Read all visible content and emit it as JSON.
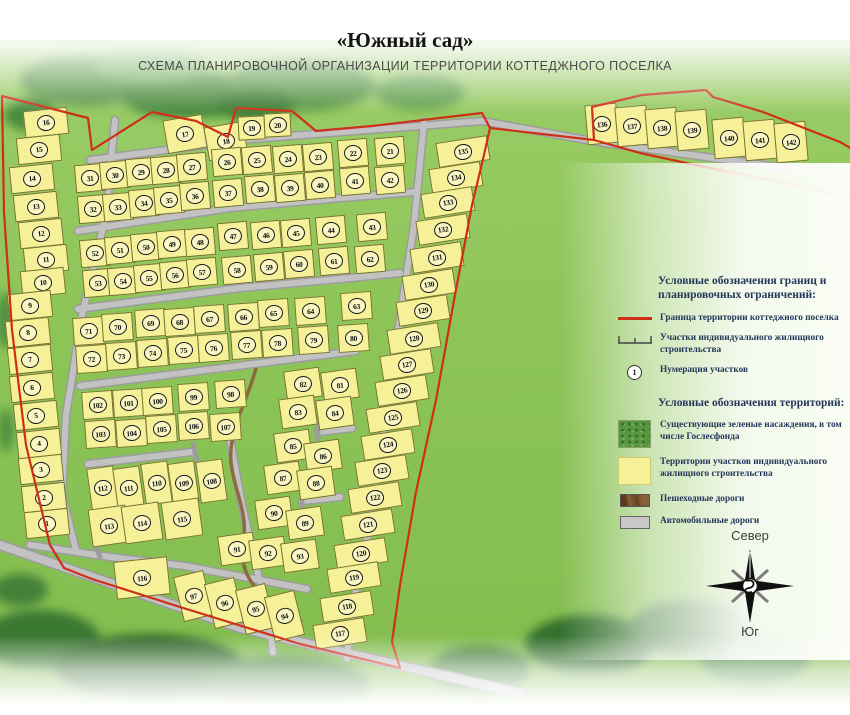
{
  "title": "«Южный сад»",
  "subtitle": "СХЕМА ПЛАНИРОВОЧНОЙ ОРГАНИЗАЦИИ ТЕРРИТОРИИ КОТТЕДЖНОГО ПОСЕЛКА",
  "compass": {
    "north": "Север",
    "south": "Юг"
  },
  "legend": {
    "boundaries": {
      "header": "Условные обозначения границ и планировочных ограничений:",
      "items": [
        {
          "icon": "red-line",
          "label": "Граница территории коттеджного поселка"
        },
        {
          "icon": "survey-line",
          "label": "Участки индивидуального жилищного строительства"
        },
        {
          "icon": "numbered-circle",
          "icon_text": "1",
          "label": "Нумерация участков"
        }
      ]
    },
    "territories": {
      "header": "Условные обозначения территорий:",
      "items": [
        {
          "icon": "green-swatch",
          "label": "Существующие зеленые насаждения, в том числе Гослесфонда"
        },
        {
          "icon": "yellow-swatch",
          "label": "Территории участков индивидуального жилищного строительства"
        },
        {
          "icon": "brown-swatch",
          "label": "Пешеходные дороги"
        },
        {
          "icon": "gray-swatch",
          "label": "Автомобильные дороги"
        }
      ]
    }
  },
  "colors": {
    "boundary-red": "#cf2e18",
    "plot-yellow": "#f6f099",
    "map-green": "#8cc457",
    "road-gray": "#c2c2c2",
    "path-brown": "#8a6038",
    "legend-text": "#24375a"
  },
  "map": {
    "plot_groups": [
      {
        "name": "left-column",
        "w": 44,
        "h": 27,
        "angle": -6,
        "plots": [
          [
            16,
            46,
            122
          ],
          [
            15,
            39,
            149
          ],
          [
            14,
            32,
            178
          ],
          [
            13,
            36,
            206
          ],
          [
            12,
            41,
            233
          ],
          [
            11,
            46,
            259
          ],
          [
            10,
            43,
            282
          ],
          [
            9,
            30,
            305
          ],
          [
            8,
            28,
            332
          ],
          [
            7,
            30,
            359
          ],
          [
            6,
            32,
            387
          ],
          [
            5,
            36,
            415
          ],
          [
            4,
            39,
            443
          ],
          [
            3,
            41,
            469
          ],
          [
            2,
            44,
            497
          ],
          [
            1,
            47,
            523
          ]
        ]
      },
      {
        "name": "north-west-pair",
        "w": 40,
        "h": 34,
        "angle": -10,
        "plots": [
          [
            17,
            185,
            134
          ],
          [
            18,
            226,
            141
          ]
        ]
      },
      {
        "name": "north-pair",
        "w": 27,
        "h": 24,
        "angle": -3,
        "plots": [
          [
            19,
            251,
            128
          ],
          [
            20,
            277,
            125
          ]
        ]
      },
      {
        "name": "block-a",
        "w": 30,
        "h": 28,
        "angle": -5,
        "plots": [
          [
            31,
            90,
            178
          ],
          [
            30,
            115,
            175
          ],
          [
            29,
            141,
            172
          ],
          [
            28,
            166,
            170
          ],
          [
            27,
            192,
            167
          ],
          [
            26,
            227,
            162
          ],
          [
            25,
            257,
            160
          ],
          [
            24,
            288,
            159
          ],
          [
            23,
            318,
            157
          ],
          [
            22,
            353,
            153
          ],
          [
            21,
            390,
            151
          ],
          [
            32,
            93,
            209
          ],
          [
            33,
            118,
            207
          ],
          [
            34,
            144,
            203
          ],
          [
            35,
            169,
            200
          ],
          [
            36,
            195,
            196
          ],
          [
            37,
            228,
            193
          ],
          [
            38,
            260,
            189
          ],
          [
            39,
            290,
            188
          ],
          [
            40,
            320,
            185
          ],
          [
            41,
            355,
            181
          ],
          [
            42,
            390,
            180
          ]
        ]
      },
      {
        "name": "block-b",
        "w": 30,
        "h": 28,
        "angle": -5,
        "plots": [
          [
            52,
            95,
            253
          ],
          [
            51,
            120,
            250
          ],
          [
            50,
            146,
            247
          ],
          [
            49,
            172,
            244
          ],
          [
            48,
            200,
            242
          ],
          [
            47,
            233,
            236
          ],
          [
            46,
            266,
            235
          ],
          [
            45,
            296,
            233
          ],
          [
            44,
            331,
            230
          ],
          [
            43,
            372,
            227
          ],
          [
            53,
            98,
            283
          ],
          [
            54,
            123,
            281
          ],
          [
            55,
            149,
            278
          ],
          [
            56,
            175,
            275
          ],
          [
            57,
            202,
            272
          ],
          [
            58,
            237,
            270
          ],
          [
            59,
            269,
            267
          ],
          [
            60,
            299,
            264
          ],
          [
            61,
            334,
            261
          ],
          [
            62,
            370,
            259
          ]
        ]
      },
      {
        "name": "block-c",
        "w": 31,
        "h": 28,
        "angle": -4,
        "plots": [
          [
            71,
            88,
            331
          ],
          [
            70,
            117,
            327
          ],
          [
            69,
            150,
            323
          ],
          [
            68,
            179,
            322
          ],
          [
            67,
            209,
            319
          ],
          [
            66,
            243,
            317
          ],
          [
            65,
            273,
            313
          ],
          [
            64,
            310,
            311
          ],
          [
            63,
            356,
            306
          ],
          [
            72,
            91,
            359
          ],
          [
            73,
            121,
            356
          ],
          [
            74,
            152,
            353
          ],
          [
            75,
            183,
            350
          ],
          [
            76,
            213,
            348
          ],
          [
            77,
            246,
            345
          ],
          [
            78,
            277,
            343
          ],
          [
            79,
            313,
            340
          ],
          [
            80,
            353,
            338
          ]
        ]
      },
      {
        "name": "block-d",
        "w": 31,
        "h": 28,
        "angle": -4,
        "plots": [
          [
            102,
            97,
            405
          ],
          [
            101,
            128,
            403
          ],
          [
            100,
            157,
            401
          ],
          [
            99,
            193,
            397
          ],
          [
            98,
            230,
            394
          ],
          [
            103,
            100,
            434
          ],
          [
            104,
            131,
            433
          ],
          [
            105,
            161,
            429
          ],
          [
            106,
            193,
            426
          ],
          [
            107,
            225,
            427
          ]
        ]
      },
      {
        "name": "block-e",
        "w": 36,
        "h": 30,
        "angle": -8,
        "plots": [
          [
            82,
            303,
            384
          ],
          [
            81,
            340,
            385
          ],
          [
            83,
            298,
            412
          ],
          [
            84,
            335,
            413
          ],
          [
            85,
            293,
            446
          ],
          [
            86,
            323,
            456
          ],
          [
            87,
            283,
            478
          ],
          [
            88,
            316,
            483
          ],
          [
            90,
            274,
            513
          ],
          [
            89,
            305,
            523
          ],
          [
            91,
            237,
            549
          ],
          [
            92,
            268,
            553
          ],
          [
            93,
            300,
            556
          ]
        ]
      },
      {
        "name": "block-f-upper",
        "w": 27,
        "h": 42,
        "angle": -8,
        "plots": [
          [
            112,
            102,
            488
          ],
          [
            111,
            128,
            488
          ],
          [
            110,
            156,
            483
          ],
          [
            109,
            183,
            483
          ],
          [
            108,
            211,
            481
          ]
        ]
      },
      {
        "name": "block-f-lower",
        "w": 38,
        "h": 38,
        "angle": -8,
        "plots": [
          [
            113,
            109,
            526
          ],
          [
            114,
            142,
            523
          ],
          [
            115,
            182,
            519
          ]
        ]
      },
      {
        "name": "plot-116-area",
        "w": 54,
        "h": 38,
        "angle": -6,
        "plots": [
          [
            116,
            142,
            578
          ]
        ]
      },
      {
        "name": "south-row",
        "w": 31,
        "h": 46,
        "angle": -14,
        "plots": [
          [
            97,
            193,
            596
          ],
          [
            96,
            224,
            603
          ],
          [
            95,
            255,
            609
          ],
          [
            94,
            284,
            616
          ]
        ]
      },
      {
        "name": "east-column",
        "w": 52,
        "h": 25,
        "angle": -9,
        "plots": [
          [
            135,
            463,
            151
          ],
          [
            134,
            456,
            177
          ],
          [
            133,
            448,
            202
          ],
          [
            132,
            443,
            229
          ],
          [
            131,
            437,
            257
          ],
          [
            130,
            429,
            284
          ],
          [
            129,
            423,
            310
          ],
          [
            128,
            414,
            338
          ],
          [
            127,
            407,
            364
          ],
          [
            126,
            402,
            390
          ],
          [
            125,
            393,
            417
          ],
          [
            124,
            388,
            444
          ],
          [
            123,
            382,
            470
          ],
          [
            122,
            375,
            497
          ],
          [
            121,
            368,
            524
          ],
          [
            120,
            361,
            553
          ],
          [
            119,
            354,
            577
          ],
          [
            118,
            347,
            606
          ],
          [
            117,
            340,
            633
          ]
        ]
      },
      {
        "name": "north-east-strip",
        "w": 32,
        "h": 40,
        "angle": -5,
        "plots": [
          [
            136,
            602,
            124
          ],
          [
            137,
            632,
            126
          ],
          [
            138,
            662,
            128
          ],
          [
            139,
            692,
            130
          ],
          [
            140,
            729,
            138
          ],
          [
            141,
            760,
            140
          ],
          [
            142,
            791,
            142
          ]
        ]
      }
    ]
  }
}
